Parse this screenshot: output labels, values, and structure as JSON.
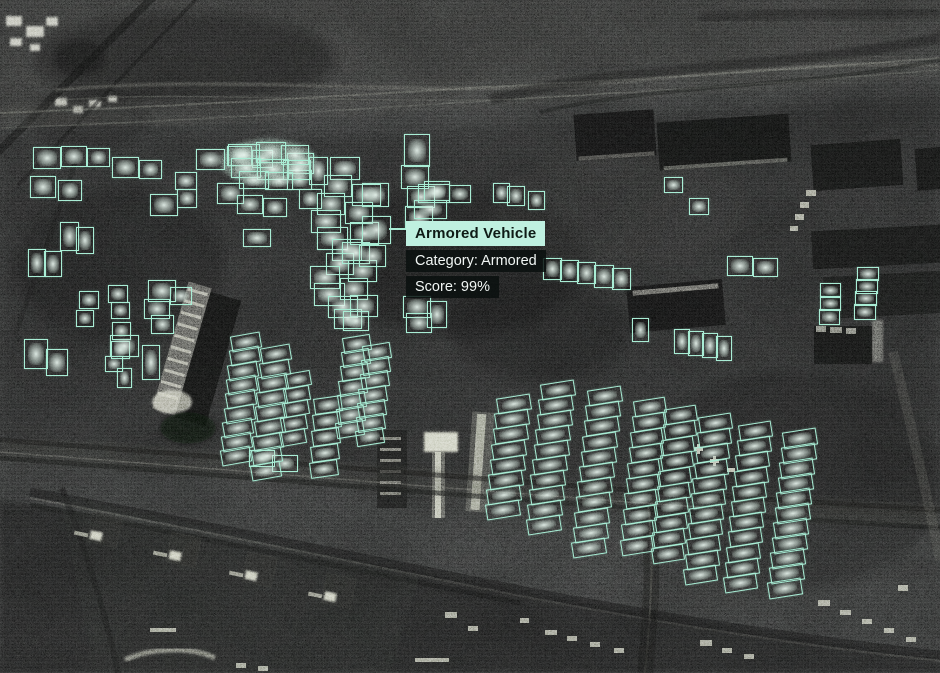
{
  "tooltip": {
    "title": "Armored Vehicle",
    "category": "Category: Armored",
    "score": "Score: 99%",
    "x": 406,
    "y": 221,
    "leader": {
      "x1": 389,
      "y1": 229,
      "x2": 406,
      "y2": 229
    },
    "anchor_box": [
      362,
      216,
      27,
      26
    ]
  },
  "theme": {
    "box_stroke": "#a9edd5",
    "box_glow": "rgba(169,237,213,0.35)",
    "vehicle_core": "rgba(233,246,239,0.92)",
    "tooltip_header_bg": "#bff0e0",
    "tooltip_header_text": "#0e1a16",
    "tooltip_row_bg": "rgba(10,15,14,0.84)",
    "tooltip_row_text": "#f1f6f4",
    "image_bg": "#212322"
  },
  "detections": {
    "singles": [
      [
        33,
        147,
        26,
        20
      ],
      [
        61,
        146,
        24,
        19
      ],
      [
        87,
        148,
        21,
        17
      ],
      [
        30,
        176,
        24,
        20
      ],
      [
        58,
        180,
        22,
        19
      ],
      [
        112,
        157,
        25,
        19
      ],
      [
        139,
        160,
        21,
        17
      ],
      [
        175,
        172,
        20,
        16
      ],
      [
        177,
        189,
        18,
        17
      ],
      [
        196,
        149,
        27,
        19
      ],
      [
        227,
        146,
        23,
        18
      ],
      [
        252,
        150,
        19,
        16
      ],
      [
        287,
        153,
        25,
        19
      ],
      [
        309,
        157,
        17,
        26
      ],
      [
        217,
        183,
        25,
        19
      ],
      [
        287,
        170,
        23,
        18
      ],
      [
        299,
        189,
        21,
        18
      ],
      [
        150,
        194,
        26,
        20
      ],
      [
        237,
        195,
        24,
        17
      ],
      [
        263,
        198,
        22,
        17
      ],
      [
        243,
        229,
        26,
        16
      ],
      [
        60,
        222,
        17,
        27
      ],
      [
        76,
        227,
        16,
        25
      ],
      [
        28,
        249,
        16,
        26
      ],
      [
        44,
        251,
        16,
        24
      ],
      [
        228,
        144,
        30,
        20
      ],
      [
        256,
        142,
        28,
        19
      ],
      [
        281,
        145,
        26,
        18
      ],
      [
        231,
        158,
        28,
        18
      ],
      [
        257,
        159,
        30,
        19
      ],
      [
        283,
        160,
        26,
        18
      ],
      [
        239,
        171,
        28,
        16
      ],
      [
        265,
        172,
        26,
        16
      ],
      [
        330,
        157,
        28,
        21
      ],
      [
        324,
        175,
        26,
        20
      ],
      [
        317,
        193,
        26,
        20
      ],
      [
        311,
        210,
        28,
        21
      ],
      [
        317,
        227,
        29,
        21
      ],
      [
        332,
        239,
        28,
        20
      ],
      [
        326,
        253,
        26,
        20
      ],
      [
        310,
        266,
        28,
        21
      ],
      [
        314,
        283,
        29,
        21
      ],
      [
        328,
        296,
        28,
        20
      ],
      [
        334,
        309,
        26,
        18
      ],
      [
        352,
        184,
        27,
        20
      ],
      [
        345,
        202,
        26,
        20
      ],
      [
        350,
        222,
        27,
        21
      ],
      [
        342,
        242,
        26,
        20
      ],
      [
        348,
        260,
        27,
        20
      ],
      [
        340,
        278,
        26,
        20
      ],
      [
        350,
        295,
        26,
        20
      ],
      [
        343,
        311,
        24,
        18
      ],
      [
        362,
        183,
        25,
        22
      ],
      [
        359,
        245,
        25,
        20
      ],
      [
        404,
        134,
        24,
        31
      ],
      [
        401,
        165,
        26,
        22
      ],
      [
        407,
        186,
        26,
        20
      ],
      [
        405,
        206,
        26,
        21
      ],
      [
        418,
        184,
        30,
        17
      ],
      [
        414,
        200,
        31,
        17
      ],
      [
        403,
        296,
        26,
        20
      ],
      [
        406,
        313,
        24,
        18
      ],
      [
        427,
        301,
        18,
        25
      ],
      [
        424,
        181,
        24,
        18
      ],
      [
        449,
        185,
        20,
        16
      ],
      [
        493,
        183,
        15,
        18
      ],
      [
        507,
        186,
        16,
        18
      ],
      [
        528,
        191,
        15,
        17
      ],
      [
        664,
        177,
        17,
        14
      ],
      [
        689,
        198,
        18,
        15
      ],
      [
        543,
        258,
        17,
        20
      ],
      [
        560,
        260,
        17,
        20
      ],
      [
        577,
        262,
        17,
        20
      ],
      [
        594,
        265,
        18,
        21
      ],
      [
        612,
        268,
        17,
        20
      ],
      [
        632,
        318,
        15,
        22
      ],
      [
        674,
        329,
        14,
        23
      ],
      [
        688,
        331,
        14,
        23
      ],
      [
        702,
        333,
        14,
        23
      ],
      [
        716,
        336,
        14,
        23
      ],
      [
        727,
        256,
        24,
        18
      ],
      [
        753,
        258,
        23,
        17
      ],
      [
        820,
        283,
        19,
        13
      ],
      [
        820,
        296,
        19,
        13
      ],
      [
        819,
        309,
        19,
        14
      ],
      [
        857,
        267,
        20,
        12
      ],
      [
        856,
        279,
        20,
        13
      ],
      [
        855,
        291,
        20,
        13
      ],
      [
        854,
        304,
        20,
        14
      ],
      [
        148,
        280,
        26,
        20
      ],
      [
        144,
        299,
        24,
        18
      ],
      [
        151,
        315,
        21,
        17
      ],
      [
        170,
        287,
        20,
        16
      ],
      [
        79,
        291,
        18,
        16
      ],
      [
        76,
        310,
        16,
        15
      ],
      [
        108,
        285,
        18,
        16
      ],
      [
        111,
        302,
        17,
        15
      ],
      [
        112,
        322,
        17,
        16
      ],
      [
        111,
        341,
        17,
        16
      ],
      [
        105,
        356,
        16,
        14
      ],
      [
        117,
        368,
        13,
        18
      ],
      [
        142,
        345,
        16,
        33
      ],
      [
        24,
        339,
        22,
        28
      ],
      [
        46,
        349,
        20,
        25
      ],
      [
        110,
        335,
        27,
        20
      ],
      [
        249,
        450,
        24,
        15
      ],
      [
        272,
        455,
        24,
        15
      ]
    ],
    "clusters": [
      {
        "x": 231,
        "y": 334,
        "w": 28,
        "h": 14,
        "n": 9,
        "dx": -1.3,
        "dy": 14.3,
        "angle": -10
      },
      {
        "x": 261,
        "y": 346,
        "w": 28,
        "h": 14,
        "n": 9,
        "dx": -1.3,
        "dy": 14.6,
        "angle": -10
      },
      {
        "x": 285,
        "y": 372,
        "w": 24,
        "h": 13,
        "n": 5,
        "dx": -1.2,
        "dy": 14.5,
        "angle": -10
      },
      {
        "x": 314,
        "y": 397,
        "w": 26,
        "h": 14,
        "n": 5,
        "dx": -1,
        "dy": 16,
        "angle": -8
      },
      {
        "x": 343,
        "y": 336,
        "w": 26,
        "h": 14,
        "n": 7,
        "dx": -1.2,
        "dy": 14.2,
        "angle": -9
      },
      {
        "x": 363,
        "y": 344,
        "w": 26,
        "h": 14,
        "n": 7,
        "dx": -1.2,
        "dy": 14.2,
        "angle": -9
      },
      {
        "x": 497,
        "y": 396,
        "w": 32,
        "h": 14,
        "n": 8,
        "dx": -1.6,
        "dy": 15.2,
        "angle": -9
      },
      {
        "x": 541,
        "y": 382,
        "w": 32,
        "h": 14,
        "n": 10,
        "dx": -1.6,
        "dy": 15,
        "angle": -9
      },
      {
        "x": 588,
        "y": 388,
        "w": 32,
        "h": 14,
        "n": 11,
        "dx": -1.6,
        "dy": 15.2,
        "angle": -9
      },
      {
        "x": 634,
        "y": 399,
        "w": 30,
        "h": 14,
        "n": 10,
        "dx": -1.5,
        "dy": 15.4,
        "angle": -9
      },
      {
        "x": 665,
        "y": 407,
        "w": 30,
        "h": 14,
        "n": 10,
        "dx": -1.5,
        "dy": 15.4,
        "angle": -9
      },
      {
        "x": 699,
        "y": 415,
        "w": 31,
        "h": 14,
        "n": 11,
        "dx": -1.5,
        "dy": 15.2,
        "angle": -9
      },
      {
        "x": 739,
        "y": 423,
        "w": 31,
        "h": 14,
        "n": 11,
        "dx": -1.5,
        "dy": 15.2,
        "angle": -9
      },
      {
        "x": 783,
        "y": 430,
        "w": 32,
        "h": 15,
        "n": 11,
        "dx": -1.5,
        "dy": 15,
        "angle": -9
      }
    ]
  }
}
